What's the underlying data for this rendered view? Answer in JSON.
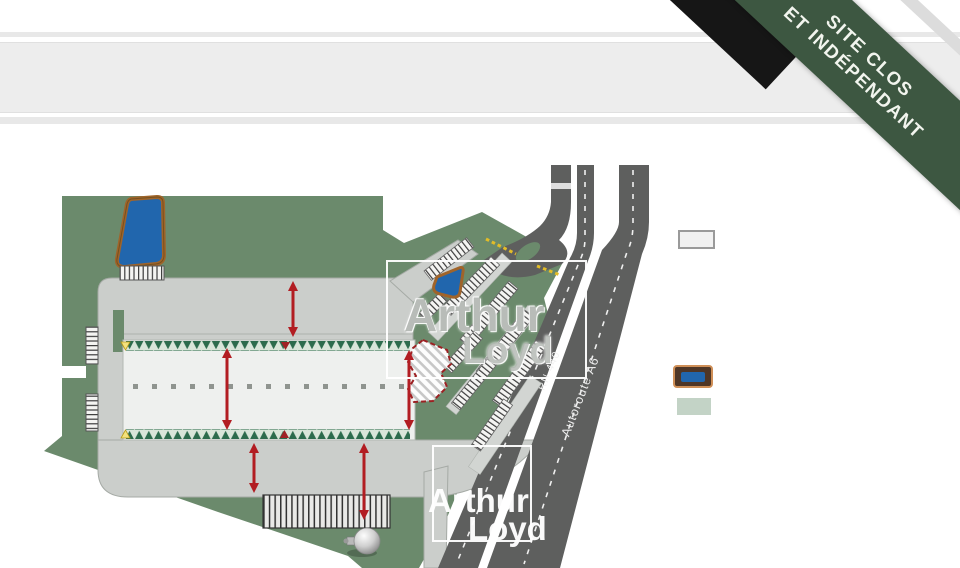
{
  "banner": {
    "line1": "SITE CLOS",
    "line2": "ET INDÉPENDANT"
  },
  "road_labels": {
    "rn440": "RN 440",
    "autoroute_a6": "Autoroute A6"
  },
  "watermark": {
    "line1": "Arthur",
    "line2": "Loyd"
  },
  "legend": {
    "items": [
      {
        "name": "building-surface",
        "swatch_fill": "#f1f1f1",
        "swatch_border": "#9a9a9a"
      },
      {
        "name": "retention-pond",
        "swatch_fill": "#2166ad",
        "swatch_border": "#cf8f57"
      },
      {
        "name": "green-space",
        "swatch_fill": "#c3d3c6",
        "swatch_border": "none"
      }
    ]
  },
  "colors": {
    "site_green": "#6b8a6c",
    "road_dark": "#5e5f5e",
    "apron_gray": "#cbcecb",
    "building_fill": "#eef0ee",
    "tree_green": "#2c6b4c",
    "arrow_red": "#b21d22",
    "pond_blue": "#2166ad",
    "pond_border": "#a0642a",
    "ribbon_green": "#3d5741",
    "stripe_gray": "#e8e8e8",
    "legend_building": "#f1f1f1",
    "legend_green": "#c3d3c6",
    "gate_yellow": "#e3bd27",
    "hatch_red": "#9c2123"
  }
}
